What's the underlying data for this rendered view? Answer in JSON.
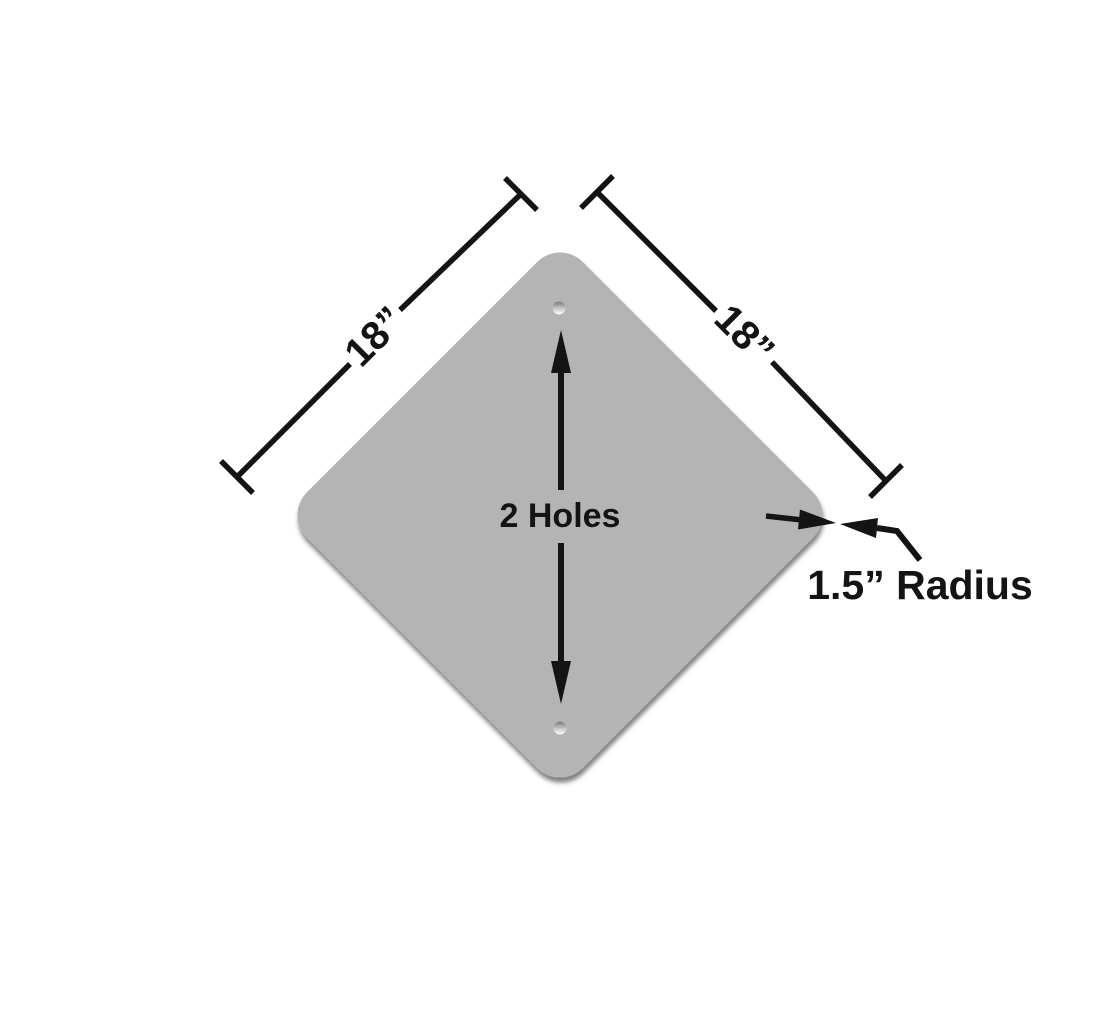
{
  "diagram": {
    "name": "diamond-sign-blank-dimension-drawing",
    "colors": {
      "background": "#ffffff",
      "plate": "#b4b4b4",
      "ink": "#141414",
      "shadow": "#000000",
      "hole_top": "#7a7a7a",
      "hole_mid": "#c9c9c9",
      "hole_bottom": "#ffffff"
    },
    "labels": {
      "left_dimension": "18”",
      "right_dimension": "18”",
      "holes": "2 Holes",
      "corner_radius": "1.5” Radius"
    }
  }
}
